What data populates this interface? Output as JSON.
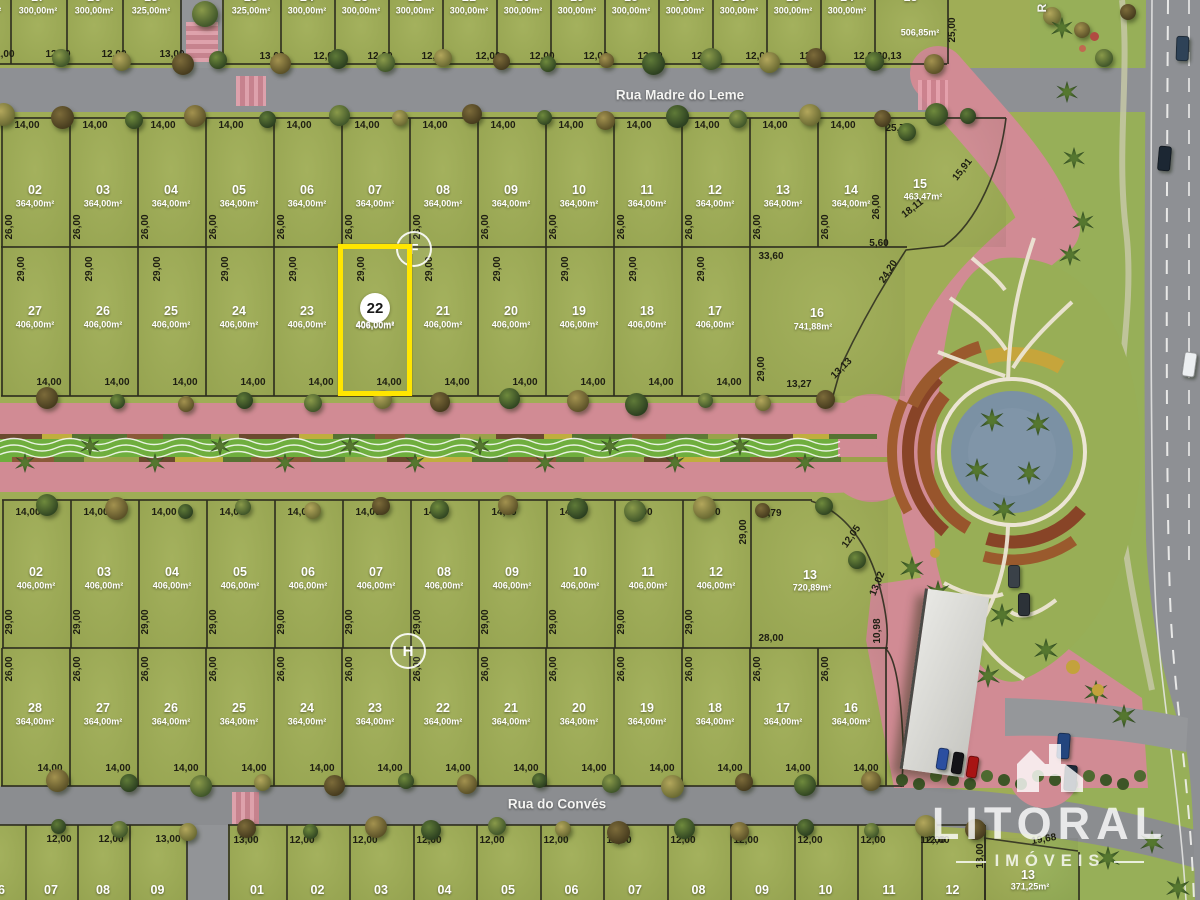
{
  "streets": {
    "top": "Rua Madre do Leme",
    "bottom": "Rua do Convés",
    "right_vertical_partial": "R"
  },
  "badges": {
    "section_f": "F",
    "section_h": "H"
  },
  "highlight": {
    "num": "22",
    "area": "406,00m²"
  },
  "watermark": {
    "brand": "LITORAL",
    "sub": "IMÓVEIS"
  },
  "colors": {
    "grass": "#9fad56",
    "lawn": "#97af58",
    "road_gray": "#8e9094",
    "road_pink": "#d18b94",
    "median_green": "#6fae3e",
    "pond": "#7b91a4",
    "path_white": "#ece5d4",
    "highlight_yellow": "#ffe600",
    "border_dark": "#2d2d1f"
  },
  "blocks": {
    "top_left": {
      "lots": [
        {
          "num": "18",
          "area": "300,00m²",
          "width": "12,00"
        },
        {
          "num": "17",
          "area": "300,00m²",
          "width": "12,00"
        },
        {
          "num": "16",
          "area": "300,00m²",
          "width": "12,00"
        },
        {
          "num": "15",
          "area": "325,00m²",
          "width": "13,00"
        }
      ]
    },
    "top_right": {
      "lots": [
        {
          "num": "25",
          "area": "325,00m²",
          "width": "13,00"
        },
        {
          "num": "24",
          "area": "300,00m²",
          "width": "12,00"
        },
        {
          "num": "23",
          "area": "300,00m²",
          "width": "12,00"
        },
        {
          "num": "22",
          "area": "300,00m²",
          "width": "12,00"
        },
        {
          "num": "21",
          "area": "300,00m²",
          "width": "12,00"
        },
        {
          "num": "20",
          "area": "300,00m²",
          "width": "12,00"
        },
        {
          "num": "19",
          "area": "300,00m²",
          "width": "12,00"
        },
        {
          "num": "18",
          "area": "300,00m²",
          "width": "12,00"
        },
        {
          "num": "17",
          "area": "300,00m²",
          "width": "12,00"
        },
        {
          "num": "16",
          "area": "300,00m²",
          "width": "12,00"
        },
        {
          "num": "15",
          "area": "300,00m²",
          "width": "12,00"
        },
        {
          "num": "14",
          "area": "300,00m²",
          "width": "12,00"
        },
        {
          "num": "13",
          "area": "506,85m²",
          "width": "20,13"
        }
      ]
    },
    "upper_row1": {
      "area": "364,00m²",
      "width": "14,00",
      "depth": "26,00",
      "nums": [
        "02",
        "03",
        "04",
        "05",
        "06",
        "07",
        "08",
        "09",
        "10",
        "11",
        "12",
        "13",
        "14"
      ],
      "corner": {
        "num": "15",
        "area": "463,47m²"
      }
    },
    "upper_row2": {
      "area": "406,00m²",
      "width": "14,00",
      "depth": "29,00",
      "nums": [
        "27",
        "26",
        "25",
        "24",
        "23",
        "22",
        "21",
        "20",
        "19",
        "18",
        "17"
      ],
      "corner": {
        "num": "16",
        "area": "741,88m²"
      }
    },
    "lower_row1": {
      "area": "406,00m²",
      "width": "14,00",
      "depth": "29,00",
      "nums": [
        "02",
        "03",
        "04",
        "05",
        "06",
        "07",
        "08",
        "09",
        "10",
        "11",
        "12"
      ],
      "corner": {
        "num": "13",
        "area": "720,89m²"
      }
    },
    "lower_row2": {
      "area": "364,00m²",
      "width": "14,00",
      "depth": "26,00",
      "nums": [
        "28",
        "27",
        "26",
        "25",
        "24",
        "23",
        "22",
        "21",
        "20",
        "19",
        "18",
        "17",
        "16"
      ]
    },
    "bottom_left": {
      "lots": [
        {
          "num": "06",
          "width": ""
        },
        {
          "num": "07",
          "width": "12,00"
        },
        {
          "num": "08",
          "width": "12,00"
        },
        {
          "num": "09",
          "width": "13,00"
        }
      ]
    },
    "bottom_right": {
      "lots": [
        {
          "num": "01",
          "width": "13,00"
        },
        {
          "num": "02",
          "width": "12,00"
        },
        {
          "num": "03",
          "width": "12,00"
        },
        {
          "num": "04",
          "width": "12,00"
        },
        {
          "num": "05",
          "width": "12,00"
        },
        {
          "num": "06",
          "width": "12,00"
        },
        {
          "num": "07",
          "width": "12,00"
        },
        {
          "num": "08",
          "width": "12,00"
        },
        {
          "num": "09",
          "width": "12,00"
        },
        {
          "num": "10",
          "width": "12,00"
        },
        {
          "num": "11",
          "width": "12,00"
        },
        {
          "num": "12",
          "width": "12,00"
        }
      ]
    },
    "bottom_corner": {
      "num": "13",
      "area": "371,25m²"
    }
  },
  "dims": [
    {
      "t": "25,00",
      "x": 953,
      "y": 30,
      "r": -90
    },
    {
      "t": "25,72",
      "x": 898,
      "y": 129,
      "r": 0
    },
    {
      "t": "15,91",
      "x": 963,
      "y": 170,
      "r": -52
    },
    {
      "t": "18,11",
      "x": 913,
      "y": 209,
      "r": -38
    },
    {
      "t": "26,00",
      "x": 877,
      "y": 207,
      "r": -90
    },
    {
      "t": "5,60",
      "x": 879,
      "y": 244,
      "r": 0
    },
    {
      "t": "33,60",
      "x": 771,
      "y": 257,
      "r": 0
    },
    {
      "t": "24,20",
      "x": 889,
      "y": 272,
      "r": -57
    },
    {
      "t": "29,00",
      "x": 762,
      "y": 369,
      "r": -90
    },
    {
      "t": "13,27",
      "x": 799,
      "y": 385,
      "r": 0
    },
    {
      "t": "13,13",
      "x": 842,
      "y": 369,
      "r": -45
    },
    {
      "t": "12,79",
      "x": 769,
      "y": 514,
      "r": 0
    },
    {
      "t": "29,00",
      "x": 744,
      "y": 532,
      "r": -90
    },
    {
      "t": "12,05",
      "x": 852,
      "y": 537,
      "r": -55
    },
    {
      "t": "13,02",
      "x": 878,
      "y": 584,
      "r": -68
    },
    {
      "t": "28,00",
      "x": 771,
      "y": 639,
      "r": 0
    },
    {
      "t": "10,98",
      "x": 878,
      "y": 631,
      "r": -90
    },
    {
      "t": "19,68",
      "x": 1044,
      "y": 840,
      "r": -10
    },
    {
      "t": "18,00",
      "x": 981,
      "y": 856,
      "r": -90
    },
    {
      "t": "12,00",
      "x": 933,
      "y": 841,
      "r": 0
    }
  ]
}
